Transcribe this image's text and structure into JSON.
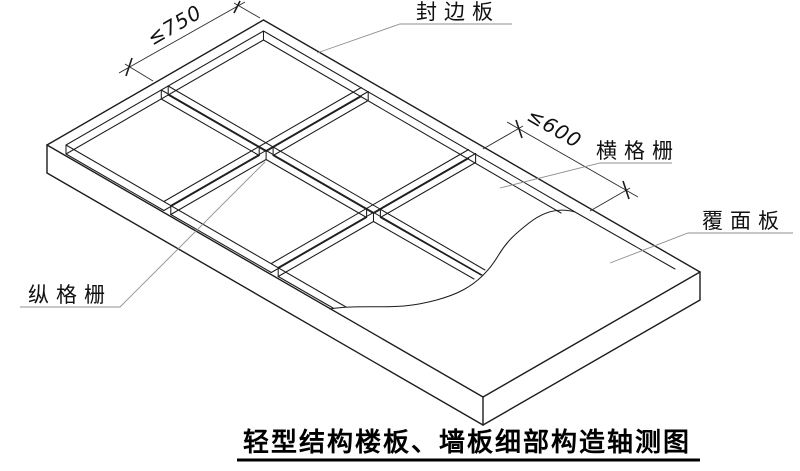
{
  "title": {
    "text": "轻型结构楼板、墙板细部构造轴测图"
  },
  "labels": {
    "edge_board": "封边板",
    "transverse_joist": "横格栅",
    "cover_panel": "覆面板",
    "longitudinal_joist": "纵格栅"
  },
  "dimensions": {
    "longitudinal_joist_spacing": "≤750",
    "transverse_joist_spacing": "≤600"
  },
  "colors": {
    "line": "#1c1c1c",
    "leader": "#8f8f8f",
    "background": "#ffffff"
  }
}
